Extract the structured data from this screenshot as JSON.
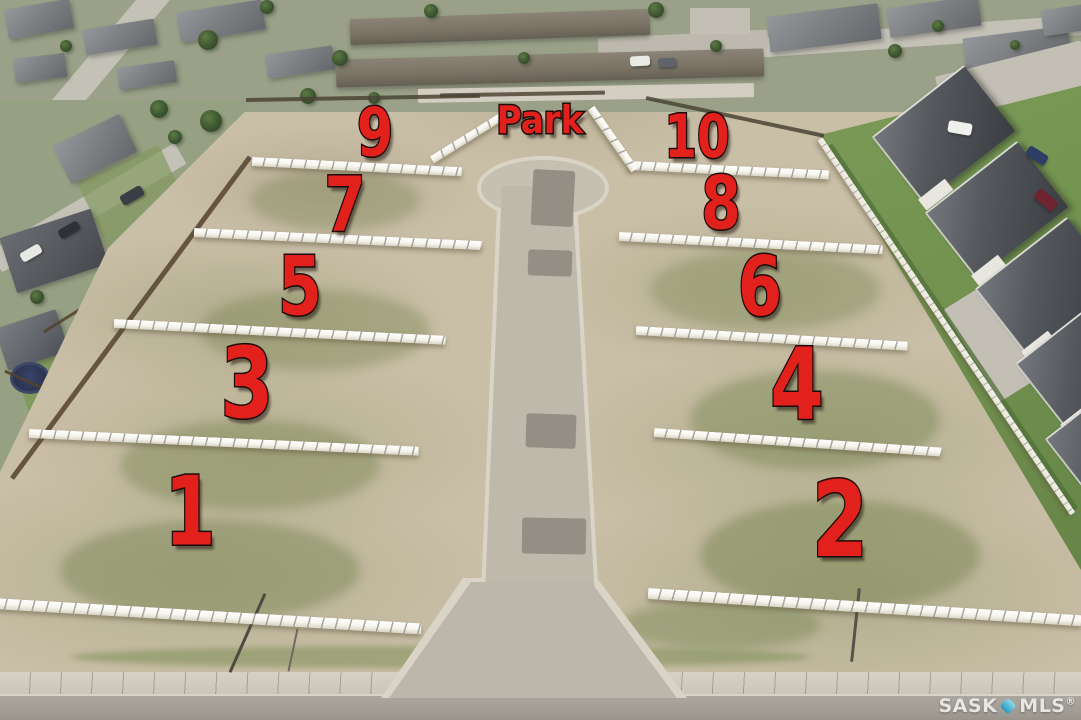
{
  "overlay": {
    "park": {
      "label": "Park"
    },
    "lots": [
      {
        "label": "9"
      },
      {
        "label": "10"
      },
      {
        "label": "7"
      },
      {
        "label": "8"
      },
      {
        "label": "5"
      },
      {
        "label": "6"
      },
      {
        "label": "3"
      },
      {
        "label": "4"
      },
      {
        "label": "1"
      },
      {
        "label": "2"
      }
    ]
  },
  "watermark": {
    "brand_primary": "SASK",
    "brand_secondary": "MLS",
    "registered_mark": "®"
  },
  "colors": {
    "lot_label_red": "#e2211c",
    "lot_label_outline": "#1d0b09",
    "dirt": "#c9bea6",
    "road": "#c0bab0",
    "asphalt_patch": "#8f8b80",
    "fence_white": "#f6f4ec",
    "lawn_green": "#7a9a55",
    "roof_dark": "#474b4f",
    "watermark_text": "#eceae6",
    "watermark_icon": "#1f98c4"
  }
}
